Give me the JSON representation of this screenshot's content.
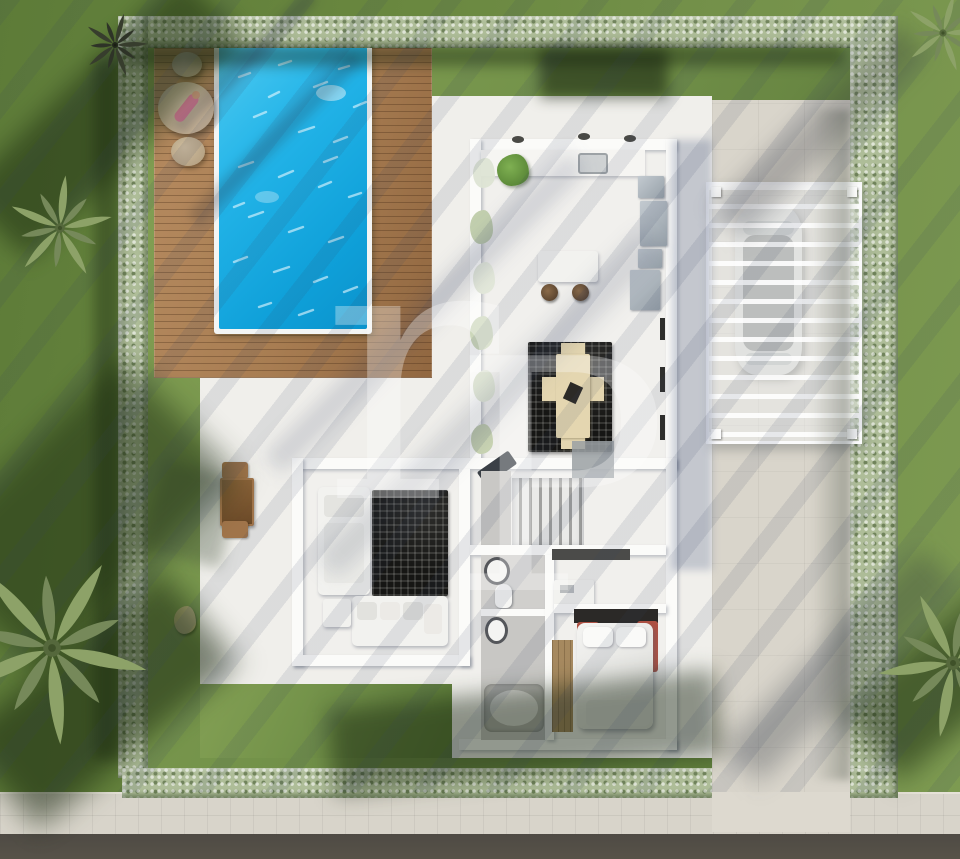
{
  "watermark": {
    "letters": [
      "r",
      "P"
    ]
  },
  "colors": {
    "hedge": "#aebd98",
    "hedge-dark": "#33491f",
    "grass-outer": "#69873f",
    "grass-lawn": "#74934a",
    "deck-wood": "#a87d52",
    "pool-water": "#1fb2e8",
    "pool-rim": "#f3f5f4",
    "terrace": "#f0efeb",
    "wall": "#fbfbf9",
    "room-floor": "#f1f0ed",
    "gray-floor": "#c9c8c5",
    "driveway": "#d9d5cb",
    "sidewalk": "#d8d4ca",
    "road": "#56514b",
    "rug": "#161614",
    "dining-table": "#e4d6b0",
    "bed-red": "#ae5143",
    "wood-floor": "#a6895f",
    "car-body": "#d3d3cf",
    "car-glass": "#90928f",
    "lounger-tan": "#c9b399",
    "person-pink": "#e2809e"
  },
  "objects": [
    "swimming-pool",
    "wood-deck",
    "sun-lounger",
    "person-sunbathing",
    "pouf",
    "hedge-fence",
    "lawn",
    "terrace",
    "outdoor-dining-set",
    "kitchen-island",
    "bar-stools",
    "kitchen-counter",
    "fridge-appliances",
    "dining-table",
    "dining-rug",
    "stairs",
    "sofa",
    "living-rug",
    "toilet",
    "washbasin",
    "bathtub",
    "wardrobe",
    "desk",
    "double-bed",
    "pergola-carport",
    "car",
    "driveway",
    "sidewalk",
    "road",
    "palm-tree",
    "rock"
  ]
}
